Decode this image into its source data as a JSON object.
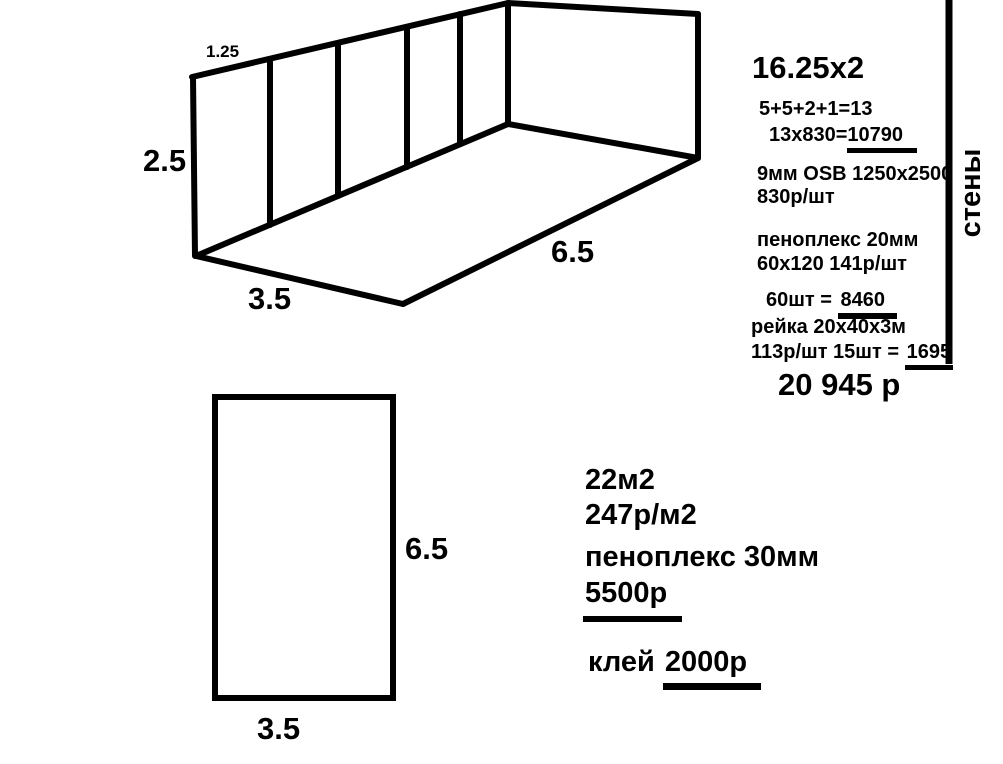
{
  "colors": {
    "ink": "#000000",
    "background": "#ffffff"
  },
  "sketch3d": {
    "dim_panel_width": "1.25",
    "dim_wall_height": "2.5",
    "dim_short_side": "3.5",
    "dim_long_side": "6.5"
  },
  "floor_plan": {
    "dim_long_side": "6.5",
    "dim_short_side": "3.5"
  },
  "walls_estimate": {
    "section_label": "стены",
    "title": "16.25x2",
    "panel_count_calc": "5+5+2+1=13",
    "osb_cost_calc": "13x830=",
    "osb_cost_result": "10790",
    "osb_spec": "9мм OSB 1250x2500",
    "osb_unit_price": "830р/шт",
    "foam_spec": "пеноплекс 20мм",
    "foam_size_price": "60х120 141р/шт",
    "foam_qty_calc": "60шт = ",
    "foam_qty_result": "8460",
    "batten_spec": "рейка 20х40х3м",
    "batten_calc": "113р/шт 15шт = ",
    "batten_result": "1695",
    "total": "20 945 р"
  },
  "floor_estimate": {
    "area": "22м2",
    "unit_price": "247р/м2",
    "foam_spec": "пеноплекс 30мм",
    "foam_total": "5500р",
    "glue_label": "клей ",
    "glue_total": "2000р"
  }
}
